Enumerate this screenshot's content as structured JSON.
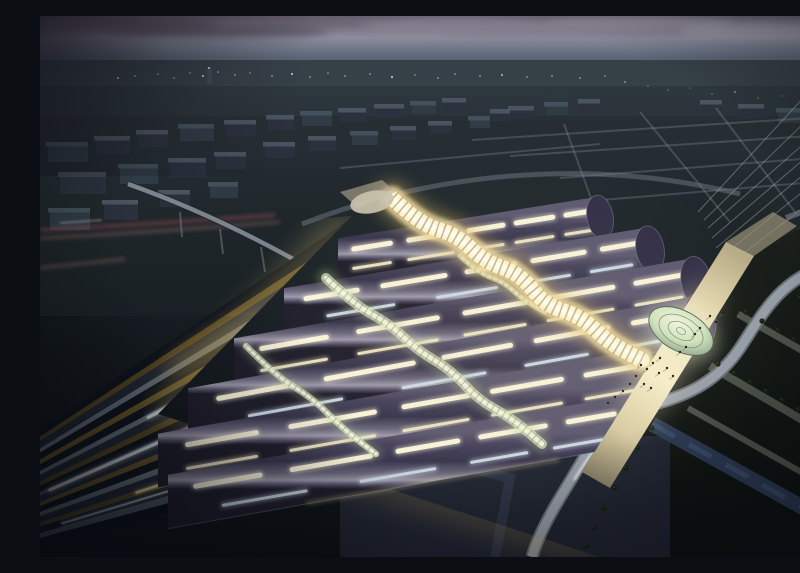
{
  "scene": {
    "kind": "architectural-night-rendering",
    "subject": "aerial view of a railway station with undulating vaulted roofs, glowing golden atrium spine, glass entrance domes, fanned illuminated tracks, twilight cityscape"
  },
  "palette": {
    "skyTop": "#67606f",
    "skyBand": "#8d8c9c",
    "skyHaze": "#5d6878",
    "landFar": "#333d44",
    "landMid": "#28323a",
    "landNear": "#232b2f",
    "groundDark": "#10151a",
    "blockFront": "#2b323e",
    "blockFront2": "#313d47",
    "blockTop": "#505a66",
    "blockTop2": "#465560",
    "roadLight": "#8d97a4",
    "ringRoad": "#78818c",
    "redTrail": "#c25a63",
    "redTrail2": "#e8938f",
    "whiteTrail": "#e8e4da",
    "vaultCrest": "#5d5970",
    "vaultDeep": "#37344c",
    "vaultSheen": "#9d99ab",
    "vaultEdge": "#201e2c",
    "capFill": "#322f48",
    "capLine": "#8e8aa2",
    "skylightWarm": "#fdf7dd",
    "skylightCool": "#cfdce8",
    "eaveGlow": "#ecd9a0",
    "eaveLine": "#9aa2b0",
    "spineGold": "#d9b865",
    "spineBright": "#eed9a0",
    "spineHot": "#fdf3cf",
    "spineCore": "#fffdf0",
    "spineGrid": "#8a7440",
    "connGreen": "#b9c89a",
    "connBright": "#dde6c0",
    "connCore": "#f4f6e2",
    "connGrid": "#7c8a58",
    "domeLight": "#eef6dd",
    "domeMid": "#cfe2c0",
    "domeEdge": "#8aa288",
    "domeLine": "#55654f",
    "domeNorth": "#c9c2ad",
    "plazaBright": "#f6eecb",
    "plazaMid": "#e8dcb4",
    "plazaDark": "#8a8168",
    "people": "#26211c",
    "parkGround": "#1b211d",
    "parkPath": "#5f675c",
    "treeDark": "#15200f",
    "treeLite": "#2c3d1e",
    "water": "#2e3c58",
    "waterLite": "#48597c",
    "sroadDark": "#6a7078",
    "sroadLite": "#9aa3ad",
    "sroadSpec": "#e3e8ee",
    "glowGold": "#e3bc5e",
    "glowPale": "#f4ecd4",
    "neFan": "#c6c9bc",
    "townLight": "#e8e4d2"
  },
  "sky": {
    "stops": [
      [
        "0",
        "#67606f"
      ],
      [
        "0.04",
        "#8d8c9c"
      ],
      [
        "0.075",
        "#5d6878"
      ],
      [
        "0.13",
        "#39434e"
      ],
      [
        "0.22",
        "#262f36"
      ],
      [
        "0.37",
        "#1f272b"
      ],
      [
        "0.65",
        "#161c21"
      ],
      [
        "1",
        "#0d1216"
      ]
    ],
    "clouds": [
      [
        90,
        8,
        180,
        7,
        "#5d5564",
        0.8
      ],
      [
        260,
        6,
        160,
        6,
        "#6f6878",
        0.7
      ],
      [
        420,
        10,
        200,
        8,
        "#8a8494",
        0.6
      ],
      [
        600,
        7,
        190,
        7,
        "#9b97a6",
        0.55
      ],
      [
        720,
        14,
        160,
        8,
        "#a7a6b2",
        0.5
      ],
      [
        180,
        16,
        220,
        6,
        "#4e4858",
        0.6
      ],
      [
        520,
        18,
        240,
        7,
        "#7e7b8c",
        0.45
      ]
    ],
    "hazeBand": [
      380,
      22,
      420,
      26
    ]
  },
  "landscape": {
    "bands": [
      [
        44,
        26,
        "#333d44",
        0.9
      ],
      [
        70,
        30,
        "#2a343a",
        0.9
      ],
      [
        100,
        32,
        "#262e33",
        0.85
      ]
    ],
    "tower": [
      167,
      52,
      5,
      16
    ],
    "lights": [
      [
        78,
        62
      ],
      [
        95,
        60
      ],
      [
        118,
        58
      ],
      [
        134,
        62
      ],
      [
        150,
        57
      ],
      [
        163,
        60
      ],
      [
        178,
        56
      ],
      [
        195,
        59
      ],
      [
        210,
        57
      ],
      [
        232,
        60
      ],
      [
        252,
        58
      ],
      [
        270,
        61
      ],
      [
        288,
        57
      ],
      [
        305,
        60
      ],
      [
        330,
        58
      ],
      [
        352,
        61
      ],
      [
        375,
        59
      ],
      [
        398,
        62
      ],
      [
        415,
        58
      ],
      [
        440,
        60
      ],
      [
        462,
        59
      ],
      [
        487,
        61
      ],
      [
        512,
        60
      ],
      [
        540,
        62
      ],
      [
        565,
        60
      ],
      [
        585,
        66
      ],
      [
        608,
        70
      ],
      [
        628,
        74
      ],
      [
        650,
        72
      ],
      [
        672,
        78
      ],
      [
        695,
        76
      ],
      [
        718,
        82
      ],
      [
        742,
        80
      ],
      [
        764,
        85
      ],
      [
        786,
        83
      ]
    ]
  },
  "city": {
    "blocks": [
      [
        8,
        130,
        40,
        16
      ],
      [
        56,
        124,
        34,
        14
      ],
      [
        98,
        118,
        30,
        13
      ],
      [
        140,
        112,
        34,
        13
      ],
      [
        186,
        108,
        30,
        12
      ],
      [
        228,
        103,
        26,
        11
      ],
      [
        262,
        99,
        30,
        11
      ],
      [
        300,
        96,
        26,
        10
      ],
      [
        336,
        92,
        28,
        10
      ],
      [
        372,
        89,
        24,
        9
      ],
      [
        404,
        86,
        22,
        9
      ],
      [
        20,
        160,
        46,
        18
      ],
      [
        80,
        152,
        38,
        16
      ],
      [
        130,
        146,
        36,
        15
      ],
      [
        176,
        140,
        30,
        13
      ],
      [
        10,
        196,
        40,
        18
      ],
      [
        64,
        188,
        34,
        16
      ],
      [
        120,
        178,
        30,
        13
      ],
      [
        170,
        170,
        28,
        12
      ],
      [
        225,
        130,
        30,
        12
      ],
      [
        270,
        124,
        26,
        11
      ],
      [
        312,
        119,
        26,
        10
      ],
      [
        352,
        114,
        24,
        10
      ],
      [
        390,
        109,
        22,
        9
      ],
      [
        430,
        104,
        20,
        8
      ],
      [
        452,
        97,
        18,
        8
      ],
      [
        470,
        94,
        24,
        9
      ],
      [
        506,
        90,
        22,
        9
      ],
      [
        540,
        87,
        20,
        8
      ],
      [
        700,
        92,
        24,
        10
      ],
      [
        738,
        96,
        28,
        11
      ],
      [
        662,
        88,
        20,
        8
      ]
    ],
    "gridRoads": [
      [
        432,
        124,
        800,
        100
      ],
      [
        470,
        140,
        800,
        118
      ],
      [
        520,
        162,
        800,
        140
      ],
      [
        562,
        184,
        800,
        164
      ],
      [
        600,
        96,
        690,
        206
      ],
      [
        676,
        92,
        758,
        200
      ],
      [
        524,
        108,
        556,
        196
      ],
      [
        300,
        152,
        560,
        128
      ]
    ],
    "redTrails": [
      "M0,214 C60,211 140,206 235,199",
      "M0,222 C70,219 150,213 240,206",
      "M0,252 L85,243"
    ],
    "whiteTrail": "M20,207 L62,204",
    "flyover": "M88,168 C150,190 205,216 262,248",
    "pylons": [
      [
        140,
        196,
        142,
        221
      ],
      [
        180,
        213,
        183,
        238
      ],
      [
        221,
        231,
        225,
        256
      ]
    ],
    "ringRoad": "M262,208 C390,158 545,140 700,178",
    "neFanLines": [
      [
        668,
        212,
        800,
        96
      ],
      [
        672,
        222,
        800,
        112
      ],
      [
        676,
        232,
        800,
        128
      ],
      [
        680,
        242,
        800,
        146
      ],
      [
        664,
        204,
        792,
        80
      ],
      [
        658,
        196,
        778,
        66
      ],
      [
        684,
        252,
        800,
        164
      ],
      [
        688,
        262,
        800,
        184
      ]
    ]
  },
  "park": {
    "groundPoly": "712,238 800,190 800,541 460,541 440,470 545,458 570,472",
    "paths": [
      [
        698,
        298,
        800,
        356,
        7
      ],
      [
        670,
        350,
        800,
        426,
        8
      ],
      [
        648,
        392,
        800,
        478,
        6
      ]
    ],
    "water": "M612,408 L800,512",
    "bottomPath": "M352,432 L470,462 L455,541",
    "trees": [
      [
        706,
        296
      ],
      [
        722,
        305
      ],
      [
        738,
        314
      ],
      [
        754,
        323
      ],
      [
        770,
        332
      ],
      [
        786,
        341
      ],
      [
        678,
        348
      ],
      [
        694,
        357
      ],
      [
        710,
        366
      ],
      [
        726,
        375
      ],
      [
        742,
        384
      ],
      [
        758,
        393
      ],
      [
        774,
        402
      ],
      [
        790,
        411
      ],
      [
        612,
        412
      ],
      [
        598,
        432
      ],
      [
        586,
        452
      ],
      [
        575,
        472
      ],
      [
        564,
        492
      ],
      [
        554,
        512
      ],
      [
        546,
        530
      ],
      [
        760,
        282
      ],
      [
        772,
        289
      ],
      [
        784,
        296
      ],
      [
        796,
        303
      ]
    ],
    "sRoad": "M800,246 C742,258 724,296 700,332 C676,368 642,382 606,390 C566,399 548,436 526,472 C510,498 498,520 492,541",
    "sRoadSpec": "M612,388 C576,398 556,430 534,464"
  },
  "tracks": {
    "focus": [
      -265,
      594
    ],
    "clip": "0,225 312,200 118,398 560,541 0,541",
    "classes": {
      "d": [
        "#0f141d",
        "#2a3140"
      ],
      "d2": [
        "#0c1118",
        "#1f2630"
      ],
      "m": [
        "#232a38",
        "#3e4656"
      ],
      "s": [
        "#6e7884",
        "#c9d2da"
      ],
      "s2": [
        "#525c68",
        "#9fa9b4"
      ],
      "g": [
        "#5a4a24",
        "#d8b75c"
      ],
      "g2": [
        "#6e5a2a",
        "#efd287"
      ]
    },
    "bands": [
      [
        -34.2,
        -33.2,
        "d"
      ],
      [
        -33.2,
        -32.5,
        "g"
      ],
      [
        -32.5,
        -31.4,
        "m"
      ],
      [
        -31.4,
        -30.7,
        "s"
      ],
      [
        -30.7,
        -29.6,
        "d"
      ],
      [
        -29.6,
        -28.8,
        "g2"
      ],
      [
        -28.8,
        -27.7,
        "d"
      ],
      [
        -27.7,
        -27.0,
        "s"
      ],
      [
        -27.0,
        -25.9,
        "m"
      ],
      [
        -25.9,
        -25.1,
        "g"
      ],
      [
        -25.1,
        -24.0,
        "d"
      ],
      [
        -24.0,
        -23.3,
        "s2"
      ],
      [
        -23.3,
        -22.2,
        "m"
      ],
      [
        -22.2,
        -21.4,
        "g2"
      ],
      [
        -21.4,
        -20.3,
        "d"
      ],
      [
        -20.3,
        -19.5,
        "s"
      ],
      [
        -19.5,
        -18.3,
        "m"
      ],
      [
        -18.3,
        -17.5,
        "g"
      ],
      [
        -17.5,
        -16.2,
        "d"
      ],
      [
        -16.2,
        -15.2,
        "s2"
      ],
      [
        -15.2,
        -13.8,
        "d2"
      ]
    ],
    "dashes": [
      [
        -32.8,
        640,
        760,
        "#ffe9ac",
        3
      ],
      [
        -30.9,
        600,
        720,
        "#fff6d8",
        3.5
      ],
      [
        -29.2,
        520,
        700,
        "#ffeebc",
        4
      ],
      [
        -27.3,
        420,
        560,
        "#e8edf2",
        3
      ],
      [
        -27.3,
        580,
        690,
        "#fdf4cf",
        3
      ],
      [
        -25.5,
        560,
        700,
        "#ffedb0",
        4
      ],
      [
        -23.6,
        300,
        470,
        "#dfe6ec",
        3
      ],
      [
        -23.6,
        520,
        660,
        "#fef2c4",
        3.5
      ],
      [
        -21.8,
        480,
        620,
        "#f6e6ae",
        3
      ],
      [
        -19.9,
        420,
        560,
        "#d6dde4",
        2.5
      ],
      [
        -18.0,
        380,
        520,
        "#e9d9a0",
        2.5
      ],
      [
        -16.8,
        300,
        430,
        "#aab4be",
        2
      ]
    ],
    "glows": [
      [
        295,
        300,
        150,
        36,
        -25,
        "#e3bc5e",
        0.38
      ],
      [
        420,
        382,
        170,
        42,
        -22,
        "#ecd07a",
        0.42
      ],
      [
        175,
        328,
        120,
        30,
        -28,
        "#c2a050",
        0.3
      ],
      [
        515,
        448,
        150,
        38,
        -17,
        "#e7c668",
        0.4
      ],
      [
        350,
        345,
        90,
        22,
        -24,
        "#f4ecd4",
        0.22
      ],
      [
        240,
        415,
        130,
        34,
        -24,
        "#b89548",
        0.3
      ]
    ],
    "edgeGlowWest": "M310,205 L122,396",
    "edgeGlowFront": "M122,396 L560,541"
  },
  "station": {
    "strips": [
      {
        "y150": 246,
        "y700": 158,
        "xw": 298,
        "xe": 560,
        "w": 44,
        "cap": true
      },
      {
        "y150": 288,
        "y700": 196,
        "xw": 244,
        "xe": 610,
        "w": 47,
        "cap": true
      },
      {
        "y150": 330,
        "y700": 234,
        "xw": 194,
        "xe": 656,
        "w": 50,
        "cap": true
      },
      {
        "y150": 372,
        "y700": 272,
        "xw": 148,
        "xe": 660,
        "w": 52,
        "cap": true
      },
      {
        "y150": 412,
        "y700": 316,
        "xw": 118,
        "xe": 610,
        "w": 54,
        "cap": false
      },
      {
        "y150": 455,
        "y700": 360,
        "xw": 128,
        "xe": 588,
        "w": 54,
        "cap": false
      }
    ],
    "rowWarm": [
      [
        0.06,
        0.2
      ],
      [
        0.27,
        0.44
      ],
      [
        0.5,
        0.63
      ],
      [
        0.68,
        0.82
      ],
      [
        0.87,
        0.97
      ]
    ],
    "rowCool": [
      [
        0.12,
        0.3
      ],
      [
        0.42,
        0.58
      ],
      [
        0.66,
        0.78
      ],
      [
        0.84,
        0.95
      ]
    ],
    "spineMain": [
      352,
      182,
      602,
      344
    ],
    "connectors": [
      [
        286,
        262,
        502,
        428
      ],
      [
        206,
        330,
        336,
        438
      ],
      [
        420,
        240,
        505,
        296
      ]
    ],
    "northStub": "300,176 342,164 356,176 318,192",
    "northDome": [
      332,
      186,
      22,
      11,
      -12
    ],
    "walkway": "686,226 714,240 570,472 542,456",
    "walkwayNE": "714,240 686,226 733,196 757,210",
    "bridgeFar": [
      746,
      202,
      800,
      181
    ],
    "southDome": [
      641,
      315,
      35,
      20,
      29
    ],
    "people": [
      [
        601,
        349
      ],
      [
        607,
        353
      ],
      [
        613,
        347
      ],
      [
        619,
        357
      ],
      [
        627,
        352
      ],
      [
        633,
        360
      ],
      [
        596,
        360
      ],
      [
        590,
        368
      ],
      [
        604,
        368
      ],
      [
        611,
        372
      ],
      [
        583,
        375
      ],
      [
        575,
        381
      ],
      [
        568,
        387
      ],
      [
        640,
        336
      ],
      [
        646,
        331
      ],
      [
        620,
        342
      ],
      [
        655,
        318
      ],
      [
        670,
        300
      ],
      [
        676,
        306
      ],
      [
        683,
        297
      ],
      [
        660,
        312
      ]
    ]
  }
}
